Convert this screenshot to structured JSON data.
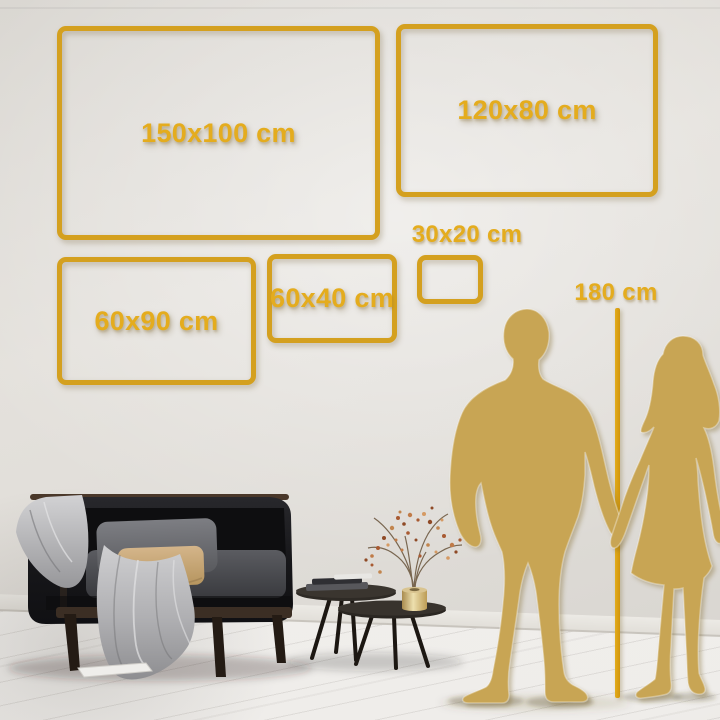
{
  "size_guide": {
    "frames": [
      {
        "id": "150x100",
        "label": "150x100 cm"
      },
      {
        "id": "120x80",
        "label": "120x80 cm"
      },
      {
        "id": "60x90",
        "label": "60x90 cm"
      },
      {
        "id": "60x40",
        "label": "60x40 cm"
      },
      {
        "id": "30x20",
        "label": "30x20 cm"
      }
    ],
    "ruler": {
      "label": "180 cm"
    }
  },
  "palette": {
    "frame_gold": "#D4A01F",
    "label_gold": "#E4AC1E",
    "ruler_gold": "#D69D12",
    "silhouette_gold": "#C8A554",
    "wall_gray": "#DFDCD7",
    "floor_white": "#F3F2F0"
  },
  "icons": {
    "man": "man-silhouette",
    "woman": "woman-silhouette"
  }
}
